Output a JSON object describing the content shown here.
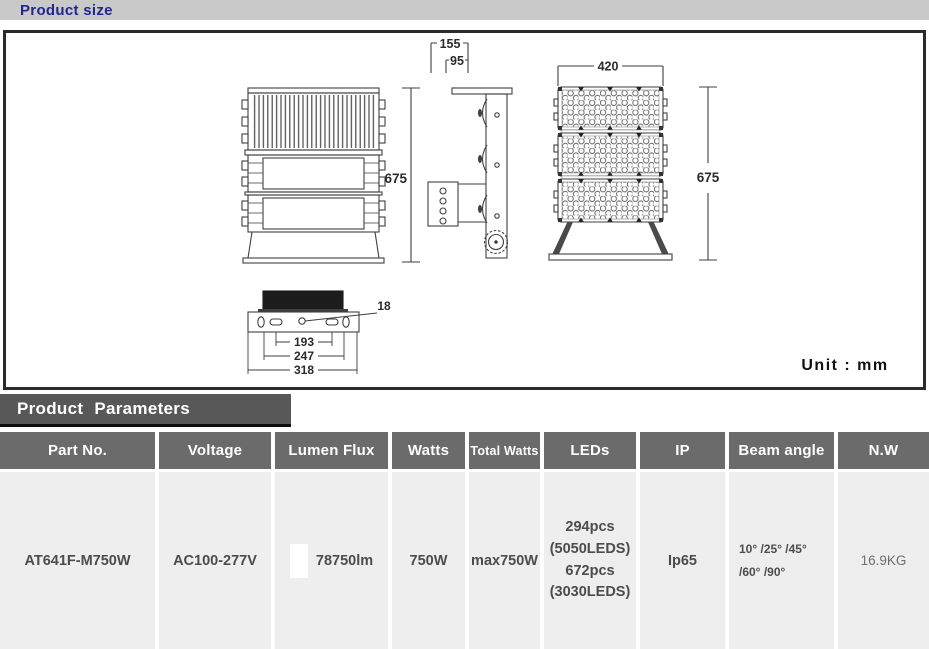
{
  "product_size": {
    "title": "Product size",
    "unit_label": "Unit : mm",
    "dims": {
      "back_height": "675",
      "side_total_depth": "155",
      "side_body_depth": "95",
      "front_width": "420",
      "front_height": "675",
      "mount_hole": "18",
      "mount_inner": "193",
      "mount_mid": "247",
      "mount_outer": "318"
    }
  },
  "product_parameters": {
    "title": "Product Parameters",
    "columns": [
      "Part No.",
      "Voltage",
      "Lumen Flux",
      "Watts",
      "Total Watts",
      "LEDs",
      "IP",
      "Beam angle",
      "N.W"
    ],
    "row": {
      "part_no": "AT641F-M750W",
      "voltage": "AC100-277V",
      "lumen_flux": "78750lm",
      "watts": "750W",
      "total_watts": "max750W",
      "leds": "294pcs\n(5050LEDS)\n672pcs\n(3030LEDS)",
      "ip": "Ip65",
      "beam_angle": "10° /25° /45°\n/60° /90°",
      "nw": "16.9KG"
    }
  },
  "colors": {
    "accent_blue": "#22268f",
    "topbar_gray": "#c9c9c9",
    "params_bar_gray": "#585858",
    "table_header_gray": "#6b6b6b",
    "row_gray": "#efeeee",
    "swatch_white": "#ffffff"
  }
}
